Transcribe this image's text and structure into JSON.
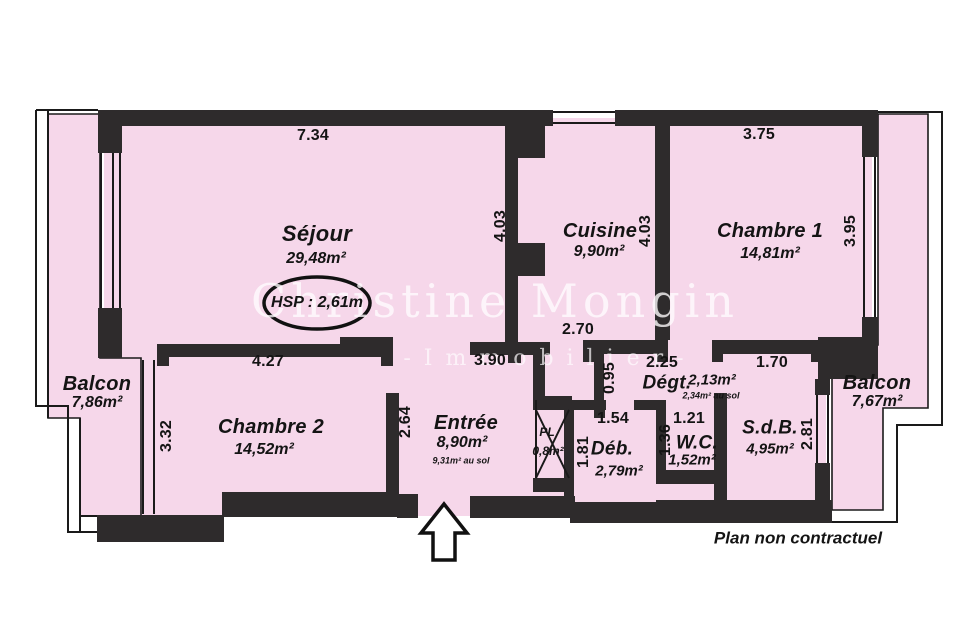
{
  "document": {
    "footer_note": "Plan non contractuel",
    "ceiling_height_label": "HSP : 2,61m",
    "watermark": {
      "line1": "Christine Mongin",
      "line2": "-Immobilier-"
    }
  },
  "colors": {
    "floor_pink": "#f6d7ea",
    "wall_black": "#2e2b2c",
    "outline": "#1a1a1a",
    "paper": "#ffffff"
  },
  "rooms": {
    "sejour": {
      "name": "Séjour",
      "area": "29,48m²"
    },
    "cuisine": {
      "name": "Cuisine",
      "area": "9,90m²"
    },
    "chambre1": {
      "name": "Chambre 1",
      "area": "14,81m²"
    },
    "chambre2": {
      "name": "Chambre 2",
      "area": "14,52m²"
    },
    "balcon_gauche": {
      "name": "Balcon",
      "area": "7,86m²"
    },
    "balcon_droit": {
      "name": "Balcon",
      "area": "7,67m²"
    },
    "entree": {
      "name": "Entrée",
      "area": "8,90m²",
      "floor_area": "9,31m² au sol"
    },
    "degt": {
      "name": "Dégt.",
      "area": "2,13m²",
      "floor_area": "2,34m² au sol"
    },
    "deb": {
      "name": "Déb.",
      "area": "2,79m²"
    },
    "wc": {
      "name": "W.C.",
      "area": "1,52m²"
    },
    "sdb": {
      "name": "S.d.B.",
      "area": "4,95m²"
    },
    "placard": {
      "name": "PL",
      "area": "0,8m²"
    }
  },
  "dims": {
    "sejour_w": {
      "value": "7.34"
    },
    "chambre1_w": {
      "value": "3.75"
    },
    "sejour_b": {
      "value": "4.27"
    },
    "entree_w": {
      "value": "3.90"
    },
    "cuisine_b": {
      "value": "2.70"
    },
    "degt_w": {
      "value": "2.25"
    },
    "chambre1_b": {
      "value": "1.70"
    },
    "deb_w": {
      "value": "1.54"
    },
    "wc_w": {
      "value": "1.21"
    },
    "sejour_h": {
      "value": "4.03"
    },
    "cuisine_h": {
      "value": "4.03"
    },
    "chambre1_h": {
      "value": "3.95"
    },
    "chambre2_h": {
      "value": "3.32"
    },
    "entree_h": {
      "value": "2.64"
    },
    "degt_h": {
      "value": "0.95"
    },
    "wc_h": {
      "value": "1.36"
    },
    "deb_h": {
      "value": "1.81"
    },
    "sdb_h": {
      "value": "2.81"
    }
  }
}
